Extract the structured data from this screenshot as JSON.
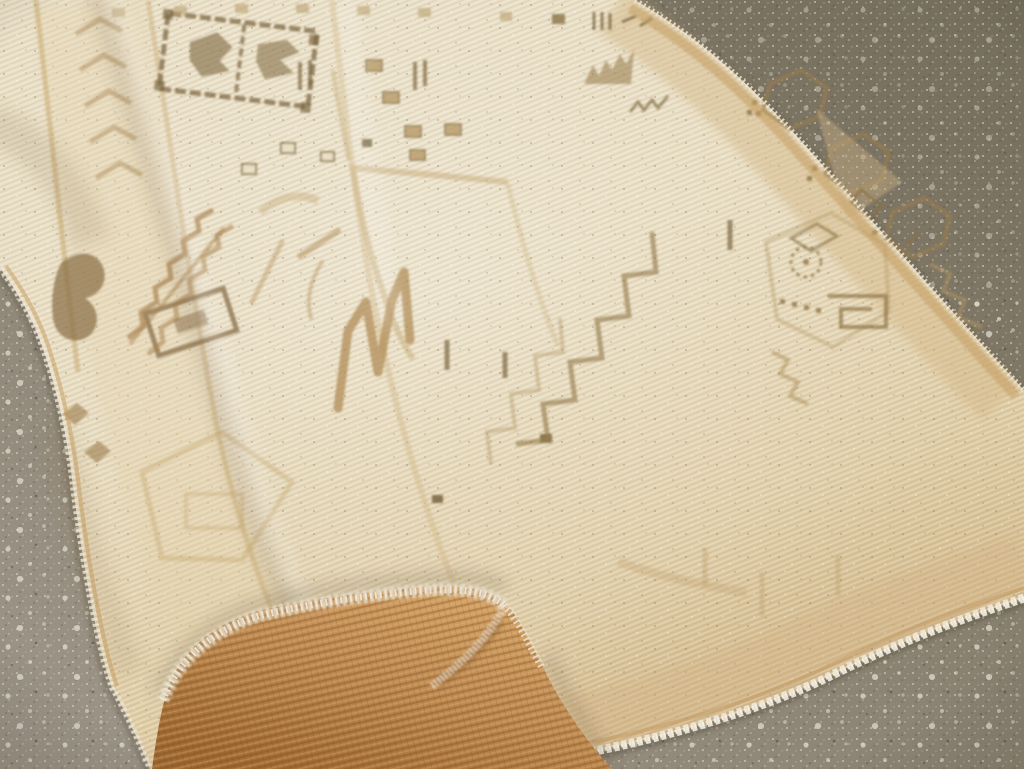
{
  "meta": {
    "type": "photograph",
    "subject": "vintage handwoven rug with folded-over corner lying on a speckled concrete floor",
    "view": "angled close-up, rug running diagonally across the frame"
  },
  "scene": {
    "floor": {
      "name": "speckled concrete floor",
      "description": "gray-taupe terrazzo-like concrete, darker olive toward the top right, scattered with small white and dark aggregate speckles"
    },
    "rug": {
      "name": "faded vintage rug",
      "description": "cream-beige low pile rug with washed-out tan and brown geometric tribal motifs and white fuzzy fringed edges",
      "motifs": [
        "dashed square medallion with leaf figures",
        "row of small squares along top edge",
        "stair-stepped squares cluster",
        "large faint square field outline",
        "stepped staircase polylines",
        "M-shaped camel zigzag",
        "serrated leaf and zigzag left border",
        "chevron chain border",
        "hexagon chain along right border",
        "hooked diamond cluster with dotted rosette",
        "scattered dark square dots"
      ]
    },
    "folded_corner": {
      "name": "folded corner flap",
      "description": "bottom corner flipped over showing the striped caramel-brown underside weave, rimmed by a fuzzy white selvedge edge"
    }
  },
  "palette": {
    "floor_dark": "#746d5b",
    "floor_mid": "#867e6d",
    "floor_light": "#9b9386",
    "speckle_light": "#e9e5d9",
    "speckle_dark": "#3e382c",
    "rug_cream_light": "#e9dfc6",
    "rug_cream": "#e6dabc",
    "rug_tan": "#dfcda6",
    "rug_warm": "#d2b88c",
    "border_tan": "#d2b585",
    "motif_brown": "#977c4e",
    "motif_dark": "#7c6743",
    "motif_camel": "#b08c55",
    "motif_faint": "#c6ab77",
    "selvage_gold": "#c59f63",
    "fringe_white": "#ece6d8",
    "flap_dark": "#a06b34",
    "flap_mid": "#bd8a52",
    "flap_light": "#d4a468",
    "shadow": "#564430"
  }
}
